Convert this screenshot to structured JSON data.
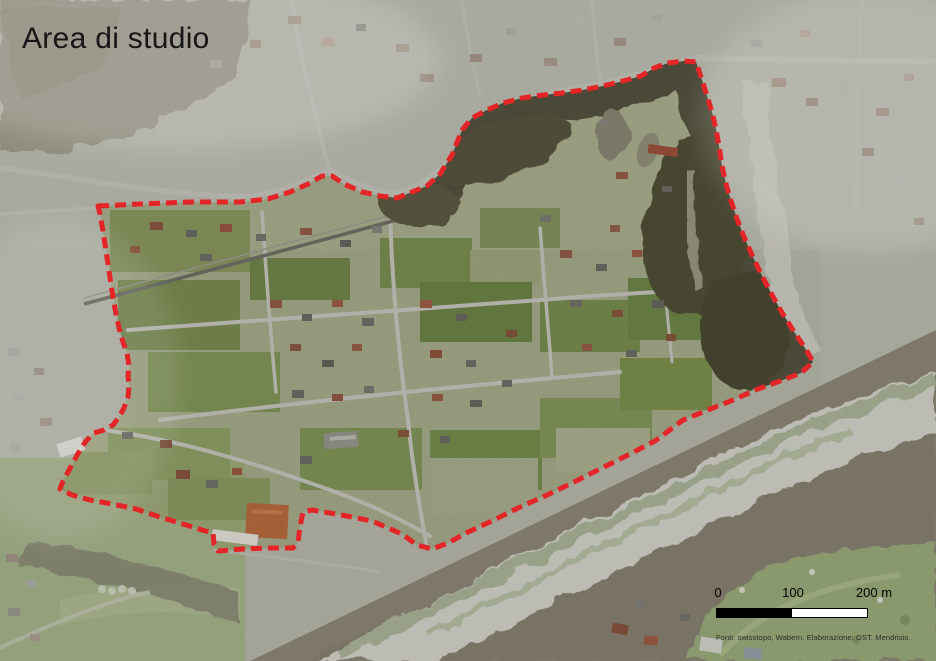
{
  "title": "Area di studio",
  "scale_bar": {
    "labels": [
      "0",
      "100",
      "200 m"
    ]
  },
  "attribution": "Fonti: swisstopo, Wabern. Elaborazione: OST, Mendrisio.",
  "boundary": {
    "color": "#e32528",
    "dash": "11 6",
    "stroke_width": 5,
    "points": [
      [
        98,
        206
      ],
      [
        140,
        204
      ],
      [
        190,
        202
      ],
      [
        240,
        202
      ],
      [
        268,
        199
      ],
      [
        290,
        192
      ],
      [
        308,
        184
      ],
      [
        322,
        176
      ],
      [
        332,
        176
      ],
      [
        344,
        184
      ],
      [
        362,
        192
      ],
      [
        380,
        196
      ],
      [
        397,
        198
      ],
      [
        412,
        192
      ],
      [
        427,
        186
      ],
      [
        440,
        174
      ],
      [
        452,
        155
      ],
      [
        462,
        130
      ],
      [
        472,
        118
      ],
      [
        487,
        110
      ],
      [
        503,
        103
      ],
      [
        522,
        98
      ],
      [
        543,
        95
      ],
      [
        562,
        93
      ],
      [
        583,
        90
      ],
      [
        603,
        86
      ],
      [
        623,
        81
      ],
      [
        641,
        76
      ],
      [
        654,
        68
      ],
      [
        668,
        63
      ],
      [
        684,
        61
      ],
      [
        696,
        62
      ],
      [
        702,
        80
      ],
      [
        707,
        96
      ],
      [
        712,
        112
      ],
      [
        716,
        129
      ],
      [
        719,
        146
      ],
      [
        722,
        166
      ],
      [
        726,
        184
      ],
      [
        731,
        201
      ],
      [
        737,
        219
      ],
      [
        744,
        237
      ],
      [
        752,
        255
      ],
      [
        761,
        274
      ],
      [
        771,
        293
      ],
      [
        781,
        311
      ],
      [
        791,
        327
      ],
      [
        801,
        342
      ],
      [
        808,
        353
      ],
      [
        813,
        362
      ],
      [
        801,
        373
      ],
      [
        783,
        380
      ],
      [
        758,
        389
      ],
      [
        733,
        400
      ],
      [
        708,
        410
      ],
      [
        683,
        420
      ],
      [
        655,
        441
      ],
      [
        628,
        455
      ],
      [
        600,
        469
      ],
      [
        572,
        483
      ],
      [
        545,
        496
      ],
      [
        518,
        508
      ],
      [
        492,
        521
      ],
      [
        468,
        532
      ],
      [
        448,
        543
      ],
      [
        432,
        549
      ],
      [
        417,
        545
      ],
      [
        402,
        534
      ],
      [
        388,
        528
      ],
      [
        372,
        521
      ],
      [
        352,
        517
      ],
      [
        330,
        513
      ],
      [
        312,
        510
      ],
      [
        303,
        512
      ],
      [
        300,
        527
      ],
      [
        298,
        542
      ],
      [
        293,
        548
      ],
      [
        268,
        548
      ],
      [
        243,
        549
      ],
      [
        218,
        551
      ],
      [
        214,
        544
      ],
      [
        213,
        533
      ],
      [
        202,
        530
      ],
      [
        183,
        524
      ],
      [
        160,
        517
      ],
      [
        136,
        509
      ],
      [
        112,
        504
      ],
      [
        90,
        500
      ],
      [
        72,
        495
      ],
      [
        60,
        489
      ],
      [
        63,
        481
      ],
      [
        68,
        472
      ],
      [
        74,
        461
      ],
      [
        80,
        450
      ],
      [
        86,
        441
      ],
      [
        94,
        433
      ],
      [
        104,
        430
      ],
      [
        113,
        425
      ],
      [
        119,
        417
      ],
      [
        124,
        408
      ],
      [
        128,
        397
      ],
      [
        129,
        386
      ],
      [
        128,
        376
      ],
      [
        129,
        366
      ],
      [
        127,
        353
      ],
      [
        123,
        342
      ],
      [
        119,
        328
      ],
      [
        115,
        309
      ],
      [
        112,
        291
      ],
      [
        109,
        271
      ],
      [
        106,
        251
      ],
      [
        103,
        231
      ],
      [
        100,
        214
      ]
    ]
  }
}
